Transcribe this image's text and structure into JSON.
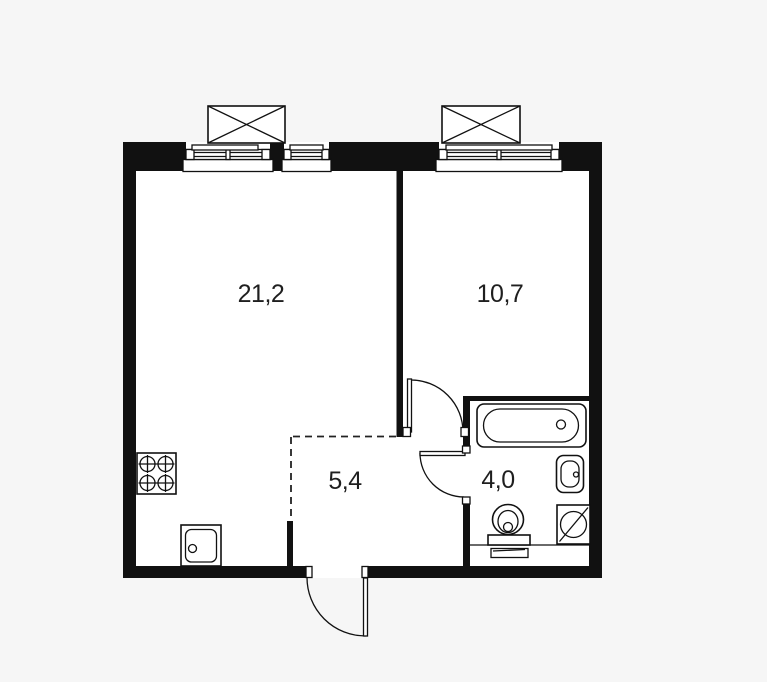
{
  "rooms": [
    {
      "name": "living-kitchen",
      "area_label": "21,2"
    },
    {
      "name": "bedroom",
      "area_label": "10,7"
    },
    {
      "name": "hallway",
      "area_label": "5,4"
    },
    {
      "name": "bathroom",
      "area_label": "4,0"
    }
  ],
  "colors": {
    "wall": "#111111",
    "line": "#111111",
    "room_fill": "#ffffff",
    "background": "#f6f6f6",
    "label_text": "#1f1f1f"
  },
  "icons": [
    "window-icon",
    "window-opening-box-icon",
    "stove-icon",
    "kitchen-sink-icon",
    "bathtub-icon",
    "wash-basin-icon",
    "toilet-icon",
    "washing-machine-icon",
    "door-swing-icon",
    "vent-duct-icon"
  ]
}
